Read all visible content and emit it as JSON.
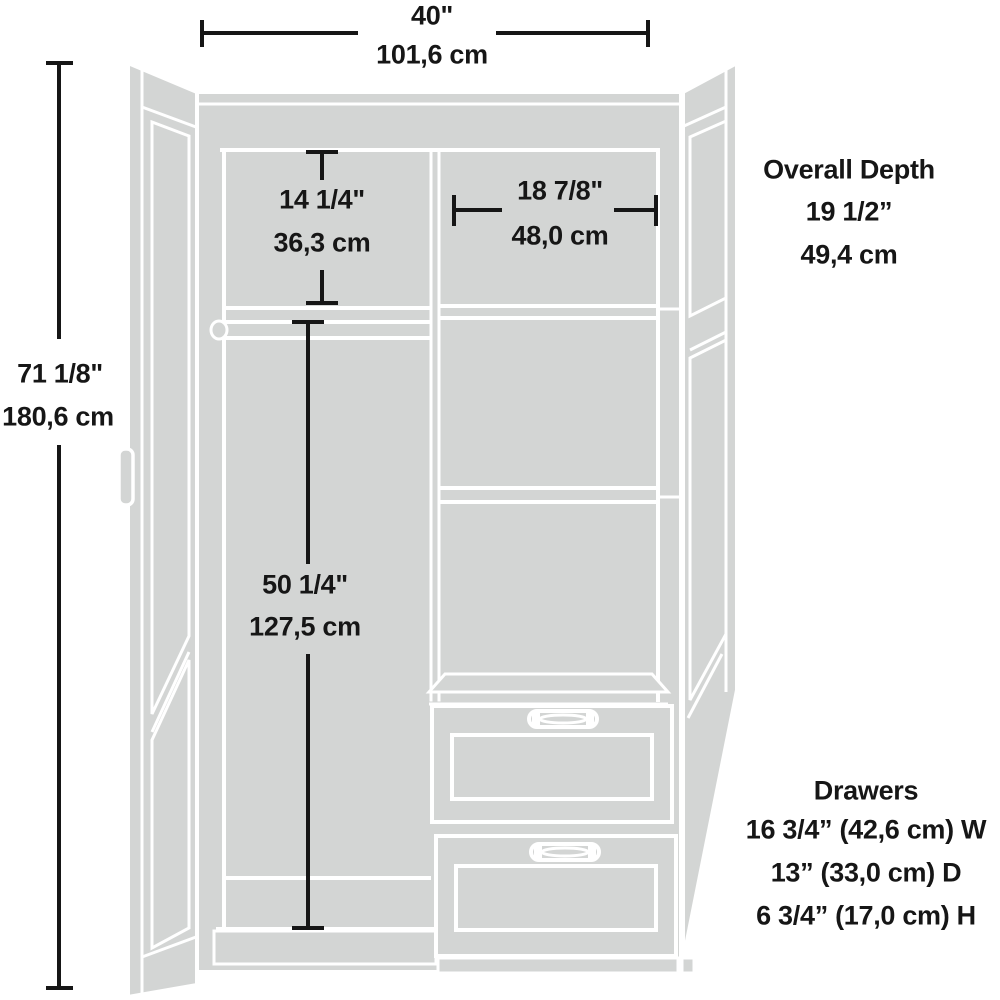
{
  "diagram": {
    "kind": "wardrobe-dimension-diagram",
    "colors": {
      "dimension_line": "#161616",
      "cabinet_fill": "#d3d5d4",
      "cabinet_edge": "#ffffff",
      "background": "#ffffff"
    },
    "labels": {
      "width_in": "40\"",
      "width_cm": "101,6 cm",
      "height_in": "71 1/8\"",
      "height_cm": "180,6 cm",
      "cubby_height_in": "14 1/4\"",
      "cubby_height_cm": "36,3 cm",
      "cubby_width_in": "18 7/8\"",
      "cubby_width_cm": "48,0 cm",
      "hanging_height_in": "50 1/4\"",
      "hanging_height_cm": "127,5 cm",
      "overall_depth_title": "Overall Depth",
      "overall_depth_in": "19 1/2”",
      "overall_depth_cm": "49,4 cm",
      "drawers_title": "Drawers",
      "drawers_width": "16 3/4” (42,6 cm) W",
      "drawers_depth": "13” (33,0 cm) D",
      "drawers_height": "6 3/4” (17,0 cm) H"
    }
  }
}
